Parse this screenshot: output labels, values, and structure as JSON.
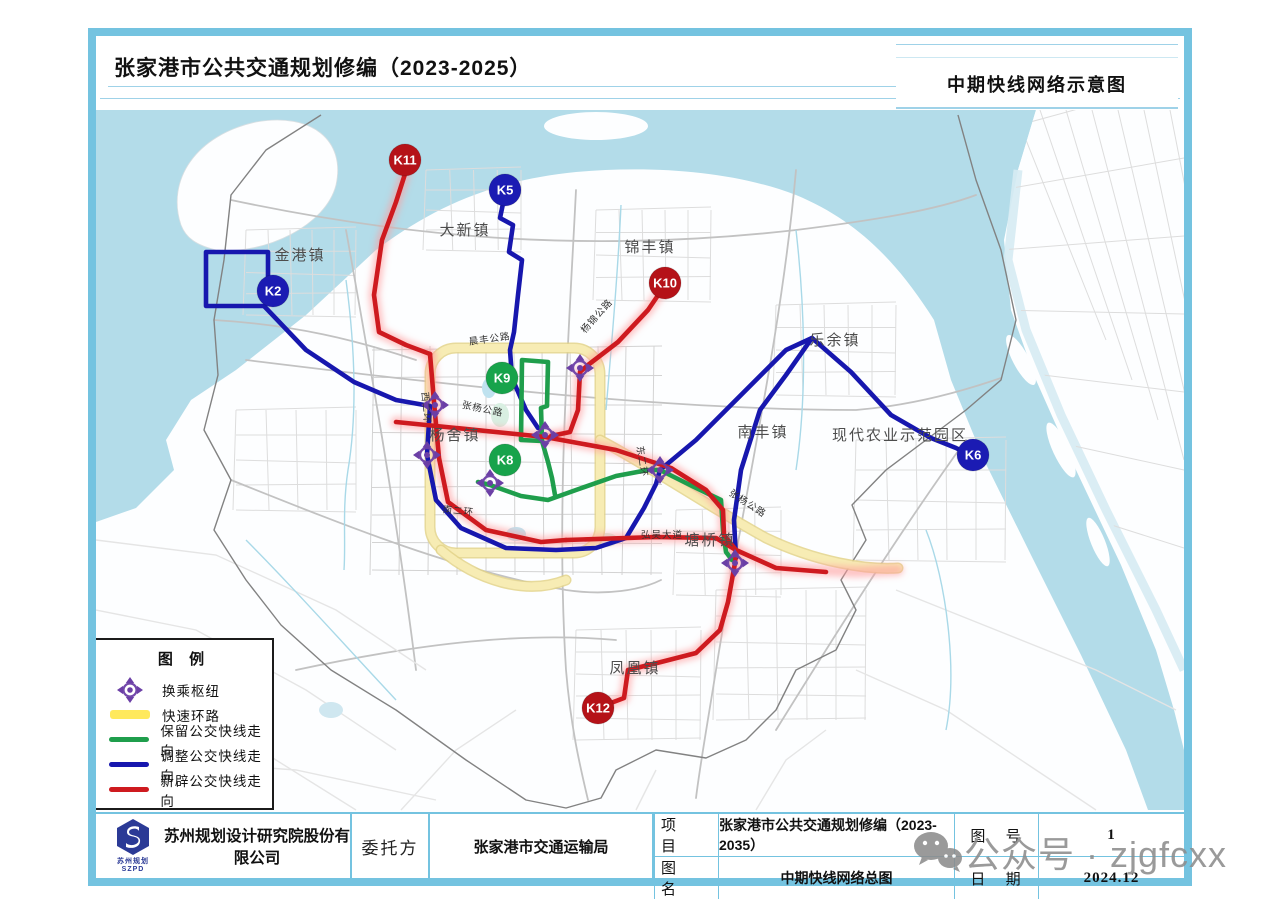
{
  "header": {
    "title_left": "张家港市公共交通规划修编（2023-2025）",
    "title_right": "中期快线网络示意图"
  },
  "legend": {
    "title": "图 例",
    "items": [
      {
        "key": "hub",
        "label": "换乘枢纽",
        "color": "#6b3fa6"
      },
      {
        "key": "ring",
        "label": "快速环路",
        "color": "#ffe95c"
      },
      {
        "key": "keep",
        "label": "保留公交快线走向",
        "color": "#1f9e4c"
      },
      {
        "key": "adjust",
        "label": "调整公交快线走向",
        "color": "#1717ae"
      },
      {
        "key": "new",
        "label": "新辟公交快线走向",
        "color": "#ce1a1f"
      }
    ]
  },
  "map": {
    "route_badges": [
      {
        "id": "K11",
        "type": "new",
        "x": 309,
        "y": 50
      },
      {
        "id": "K5",
        "type": "adjust",
        "x": 409,
        "y": 80
      },
      {
        "id": "K2",
        "type": "adjust",
        "x": 177,
        "y": 181
      },
      {
        "id": "K10",
        "type": "new",
        "x": 569,
        "y": 173
      },
      {
        "id": "K9",
        "type": "keep",
        "x": 406,
        "y": 268
      },
      {
        "id": "K8",
        "type": "keep",
        "x": 409,
        "y": 350
      },
      {
        "id": "K6",
        "type": "adjust",
        "x": 877,
        "y": 345
      },
      {
        "id": "K12",
        "type": "new",
        "x": 502,
        "y": 598
      }
    ],
    "badge_colors": {
      "new": "#b51218",
      "adjust": "#1b1bb3",
      "keep": "#17a34b"
    },
    "towns": [
      {
        "name": "金港镇",
        "x": 204,
        "y": 150
      },
      {
        "name": "大新镇",
        "x": 369,
        "y": 125
      },
      {
        "name": "锦丰镇",
        "x": 554,
        "y": 142
      },
      {
        "name": "乐余镇",
        "x": 739,
        "y": 235
      },
      {
        "name": "南丰镇",
        "x": 667,
        "y": 327
      },
      {
        "name": "现代农业示范园区",
        "x": 804,
        "y": 330
      },
      {
        "name": "杨舍镇",
        "x": 359,
        "y": 330
      },
      {
        "name": "塘桥镇",
        "x": 614,
        "y": 435
      },
      {
        "name": "凤凰镇",
        "x": 539,
        "y": 563
      }
    ],
    "road_labels": [
      {
        "name": "晨丰公路",
        "x": 394,
        "y": 232,
        "rot": -8
      },
      {
        "name": "杨锦公路",
        "x": 503,
        "y": 208,
        "rot": -48
      },
      {
        "name": "张杨公路",
        "x": 386,
        "y": 302,
        "rot": 12
      },
      {
        "name": "西二环",
        "x": 327,
        "y": 298,
        "rot": 85
      },
      {
        "name": "东二环",
        "x": 543,
        "y": 352,
        "rot": 82
      },
      {
        "name": "南二环",
        "x": 362,
        "y": 404,
        "rot": 6
      },
      {
        "name": "弘吴大道",
        "x": 566,
        "y": 428,
        "rot": 0
      },
      {
        "name": "张杨公路",
        "x": 650,
        "y": 396,
        "rot": 33
      }
    ],
    "hub_count": 7
  },
  "titleblock": {
    "company": "苏州规划设计研究院股份有限公司",
    "logo_sub1": "苏州规划",
    "logo_sub2": "SZPD",
    "client_label": "委托方",
    "client": "张家港市交通运输局",
    "row1_label": "项 目",
    "row1_value": "张家港市公共交通规划修编（2023-2035）",
    "row2_label": "图 名",
    "row2_value": "中期快线网络总图",
    "row1_label_r": "图 号",
    "row1_value_r": "1",
    "row2_label_r": "日 期",
    "row2_value_r": "2024.12"
  },
  "watermark": {
    "text": "公众号 · zjgfcxx"
  }
}
